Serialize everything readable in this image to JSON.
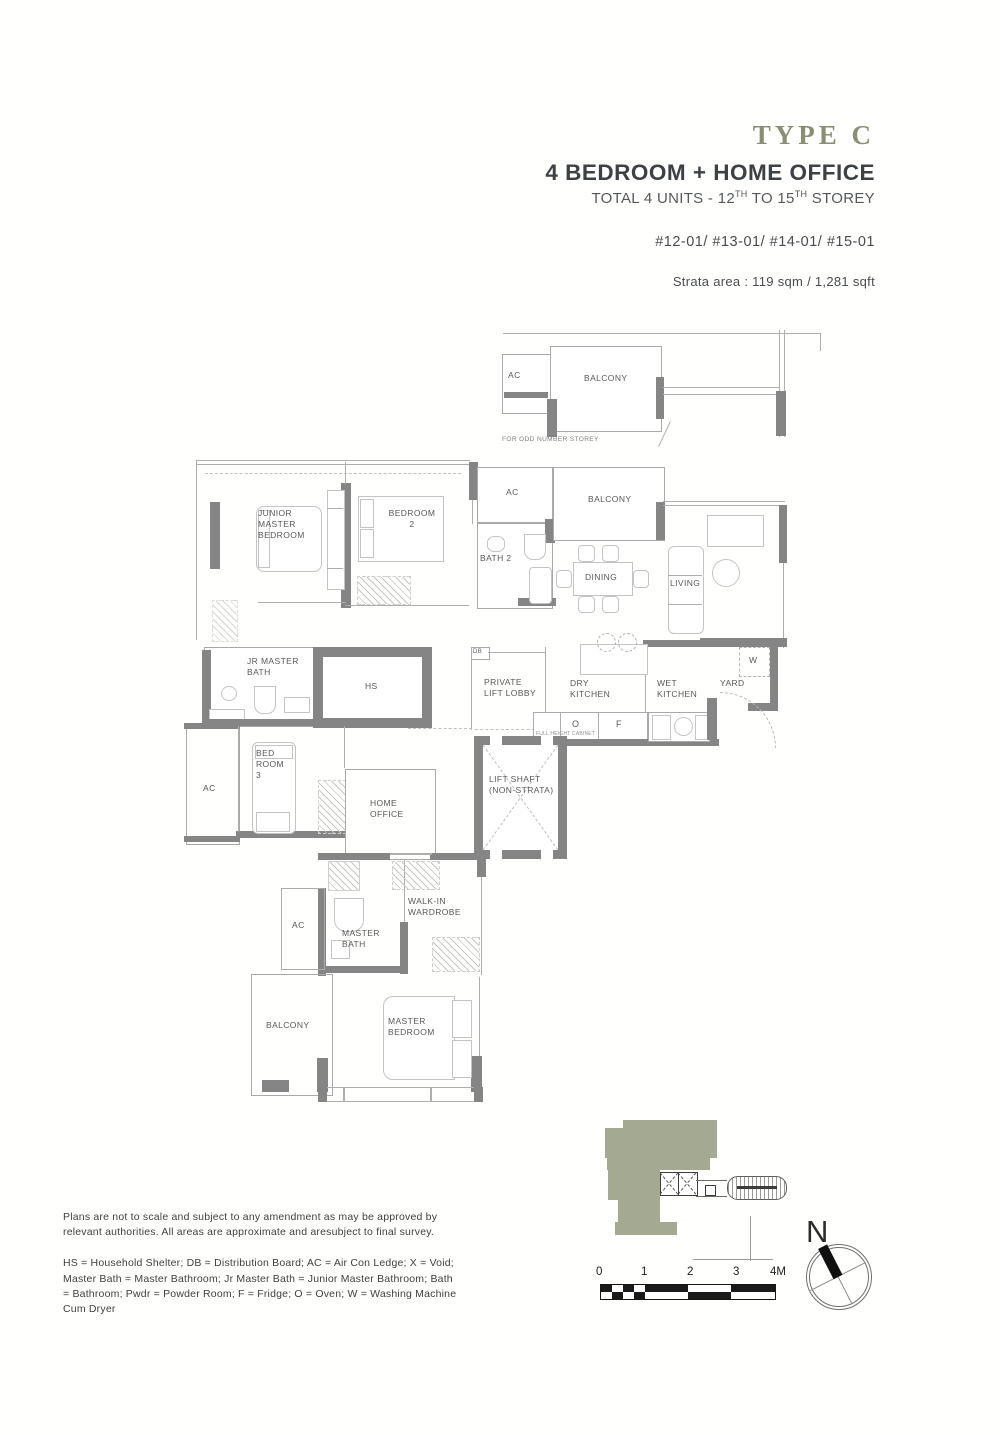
{
  "header": {
    "type_label": "TYPE C",
    "title": "4 BEDROOM + HOME OFFICE",
    "storey": {
      "p1": "TOTAL 4 UNITS - 12",
      "s1": "TH",
      "p2": " TO 15",
      "s2": "TH",
      "p3": " STOREY"
    },
    "units_line": "#12-01/ #13-01/ #14-01/ #15-01",
    "strata_line": "Strata area : 119 sqm / 1,281 sqft"
  },
  "detail_plan": {
    "ac": "AC",
    "balcony": "BALCONY",
    "note": "FOR ODD NUMBER STOREY"
  },
  "rooms": {
    "junior_master_bedroom": "JUNIOR\nMASTER\nBEDROOM",
    "bedroom_2": "BEDROOM\n2",
    "ac_top": "AC",
    "bath_2": "BATH 2",
    "balcony_top": "BALCONY",
    "dining": "DINING",
    "living": "LIVING",
    "jr_master_bath": "JR MASTER\nBATH",
    "hs": "HS",
    "db": "DB",
    "private_lift_lobby": "PRIVATE\nLIFT LOBBY",
    "dry_kitchen": "DRY\nKITCHEN",
    "wet_kitchen": "WET\nKITCHEN",
    "yard": "YARD",
    "washer": "W",
    "oven": "O",
    "fridge": "F",
    "full_height_cabinet": "FULL HEIGHT CABINET",
    "ac_left": "AC",
    "bedroom_3": "BED\nROOM\n3",
    "home_office": "HOME\nOFFICE",
    "lift_shaft": "LIFT SHAFT\n(NON-STRATA)",
    "ac_lower": "AC",
    "master_bath": "MASTER\nBATH",
    "walk_in_wardrobe": "WALK-IN\nWARDROBE",
    "balcony_lower": "BALCONY",
    "master_bedroom": "MASTER\nBEDROOM"
  },
  "scale_bar": {
    "labels": [
      "0",
      "1",
      "2",
      "3",
      "4M"
    ]
  },
  "compass": {
    "north": "N"
  },
  "footer": {
    "disclaimer": "Plans are not to scale and subject to any amendment as may be approved by relevant authorities. All areas are approximate and aresubject to final survey.",
    "legend": "HS = Household Shelter; DB = Distribution Board; AC = Air Con Ledge; X = Void; Master Bath = Master Bathroom; Jr Master Bath = Junior Master Bathroom; Bath = Bathroom; Pwdr = Powder Room; F = Fridge; O = Oven; W = Washing Machine Cum Dryer"
  },
  "colors": {
    "accent_olive": "#8B8E75",
    "keyplan_sage": "#A4AA92",
    "wall_gray": "#858585"
  }
}
